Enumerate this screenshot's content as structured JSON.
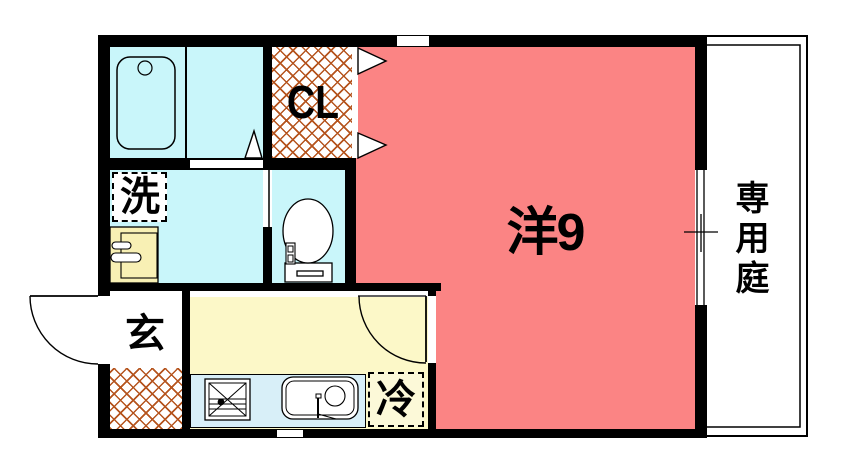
{
  "plan": {
    "rooms": {
      "main_room": {
        "label": "洋9"
      },
      "closet": {
        "label": "CL"
      },
      "laundry": {
        "label": "洗"
      },
      "entrance": {
        "label": "玄"
      },
      "refrigerator": {
        "label": "冷"
      },
      "garden": {
        "label": "専用庭"
      }
    },
    "colors": {
      "room_pink": "#FB8484",
      "wet_area_cyan": "#C9F6FA",
      "kitchen_yellow": "#FCF8C8",
      "counter_blue": "#D8EFF8",
      "vanity_yellow": "#F8F0B4",
      "hatch_orange": "#B5541E",
      "wall_black": "#000000"
    }
  }
}
